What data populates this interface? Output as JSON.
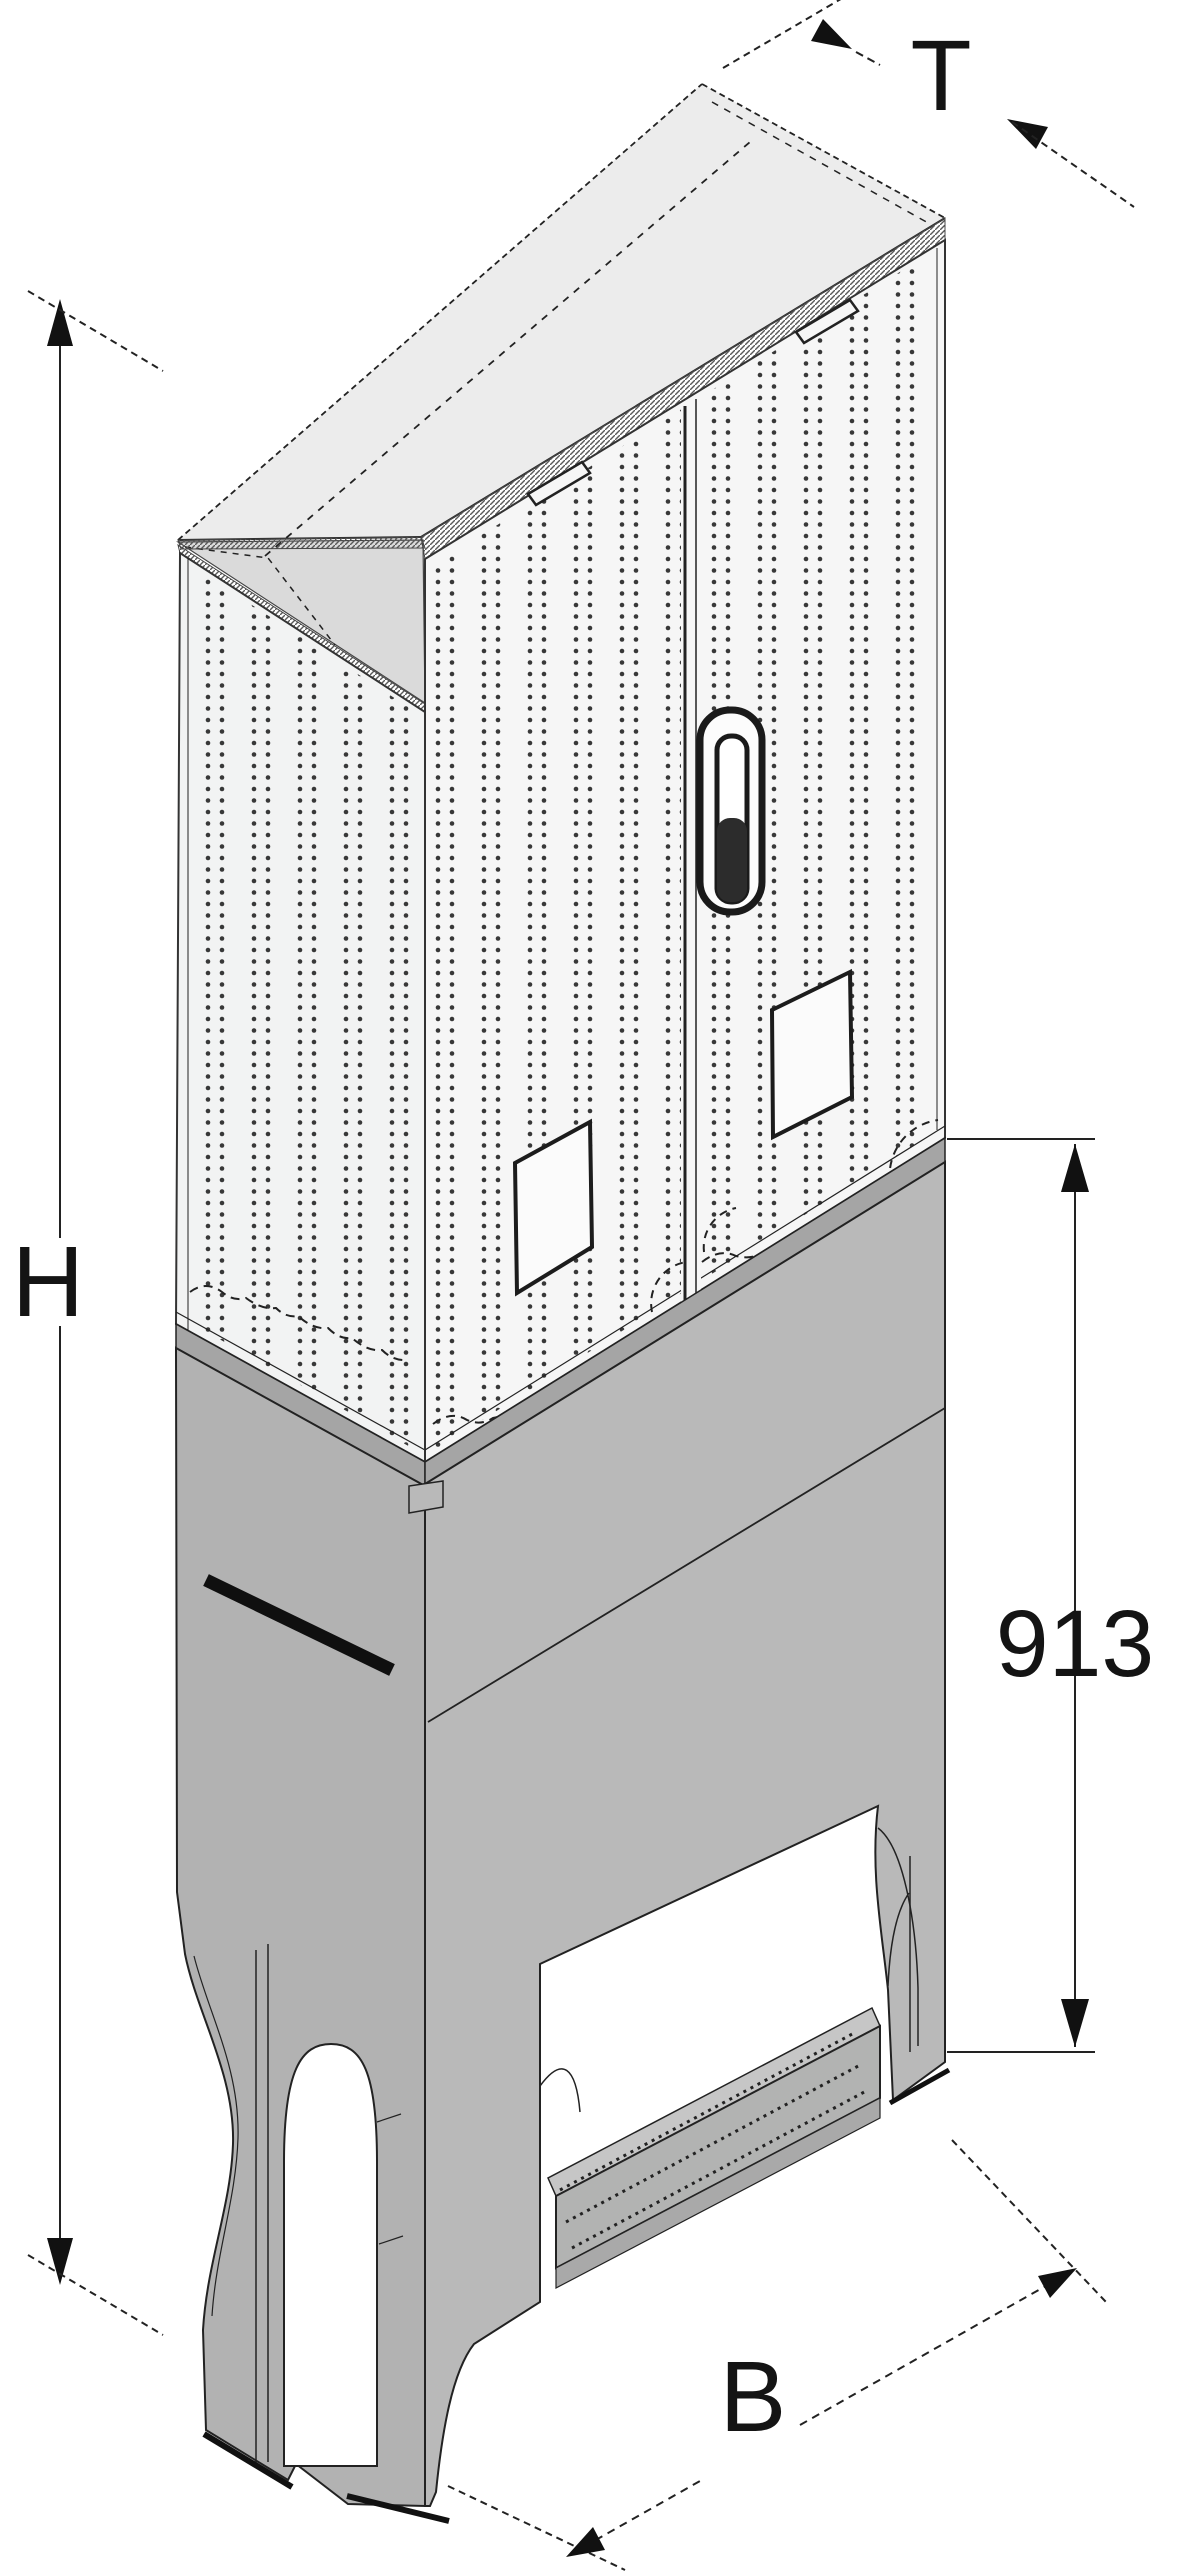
{
  "diagram": {
    "dimension_labels": {
      "height": "H",
      "depth": "T",
      "width": "B",
      "base_height": "913"
    },
    "colors": {
      "background": "#ffffff",
      "roof_top": "#ececec",
      "roof_underside": "#dadada",
      "left_face": "#f2f3f3",
      "front_doors": "#f6f6f6",
      "pedestal_left": "#b2b2b2",
      "pedestal_front": "#b9b9b9",
      "pedestal_collar": "#a5a5a5",
      "base_beam": "#b2b3b2",
      "line": "#222222",
      "perforation_dot": "#383838"
    }
  }
}
